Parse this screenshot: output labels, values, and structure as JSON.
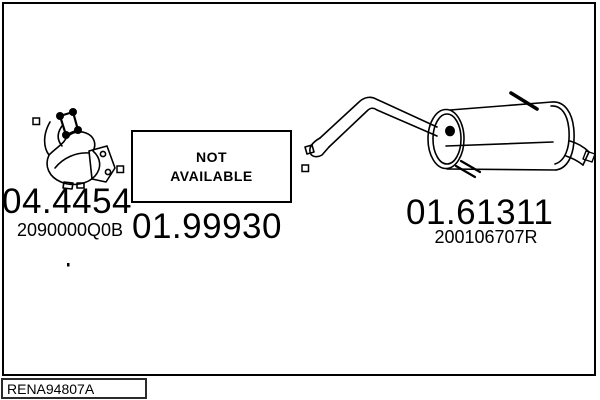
{
  "colors": {
    "background": "#ffffff",
    "line": "#000000",
    "text": "#000000",
    "footer_box_border": "#2b2b2b"
  },
  "diagram": {
    "reference_code": "RENA94807A",
    "not_available": {
      "line1": "NOT",
      "line2": "AVAILABLE"
    },
    "parts": [
      {
        "part_number": "04.4454",
        "oem_number": "2090000Q0B",
        "drawing": "catalytic-converter"
      },
      {
        "part_number": "01.99930",
        "oem_number": "",
        "drawing": "not-available"
      },
      {
        "part_number": "01.61311",
        "oem_number": "200106707R",
        "drawing": "rear-muffler"
      }
    ]
  }
}
